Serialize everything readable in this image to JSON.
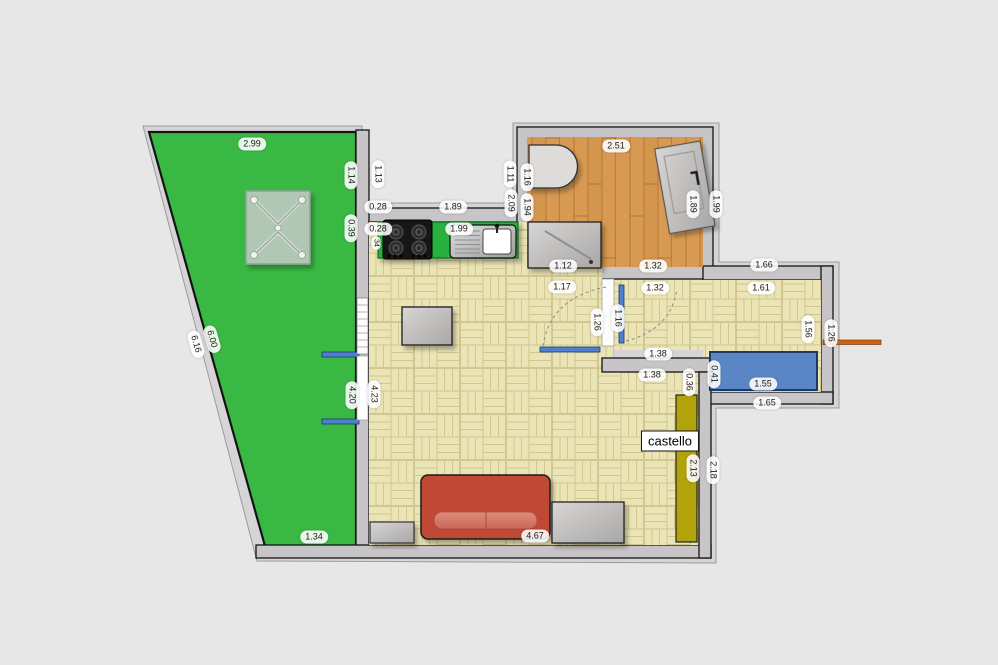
{
  "plan": {
    "type": "apartment-floor-plan",
    "room_label": "castello",
    "areas": [
      "garden",
      "kitchen",
      "bathroom",
      "living-room",
      "hallway",
      "corridor"
    ],
    "colors": {
      "background": "#e7e7e7",
      "garden_green": "#3ab844",
      "parquet": "#ebe4b6",
      "bathroom_wood": "#d89a52",
      "wall_gray": "#c7c5c7",
      "kitchen_counter_green": "#28b23c",
      "sofa_red": "#bf4a36",
      "wardrobe_blue": "#5b86c6",
      "castello_strip_yellow": "#b2a30c",
      "door_window_blue": "#4e7fd0",
      "entrance_door_orange": "#cf6414"
    }
  },
  "dimensions": [
    {
      "text": "2.99",
      "x": 252,
      "y": 144,
      "rot": 0
    },
    {
      "text": "1.14",
      "x": 351,
      "y": 175,
      "rot": 90
    },
    {
      "text": "0.39",
      "x": 351,
      "y": 228,
      "rot": 90
    },
    {
      "text": "1.13",
      "x": 378,
      "y": 174,
      "rot": 90
    },
    {
      "text": "0.28",
      "x": 378,
      "y": 207,
      "rot": 0
    },
    {
      "text": "1.89",
      "x": 453,
      "y": 207,
      "rot": 0
    },
    {
      "text": "1.11",
      "x": 510,
      "y": 174,
      "rot": 90
    },
    {
      "text": "2.09",
      "x": 511,
      "y": 203,
      "rot": 90
    },
    {
      "text": "0.28",
      "x": 378,
      "y": 229,
      "rot": 0
    },
    {
      "text": "34",
      "x": 376,
      "y": 243,
      "rot": 90,
      "small": true
    },
    {
      "text": "1.99",
      "x": 459,
      "y": 229,
      "rot": 0
    },
    {
      "text": "6.00",
      "x": 212,
      "y": 339,
      "rot": 74
    },
    {
      "text": "6.16",
      "x": 196,
      "y": 344,
      "rot": 74
    },
    {
      "text": "4.20",
      "x": 352,
      "y": 395,
      "rot": 90
    },
    {
      "text": "4.23",
      "x": 374,
      "y": 394,
      "rot": 90
    },
    {
      "text": "1.34",
      "x": 314,
      "y": 537,
      "rot": 0
    },
    {
      "text": "2.51",
      "x": 616,
      "y": 146,
      "rot": 0
    },
    {
      "text": "1.16",
      "x": 527,
      "y": 177,
      "rot": 90
    },
    {
      "text": "1.94",
      "x": 527,
      "y": 207,
      "rot": 90
    },
    {
      "text": "1.89",
      "x": 693,
      "y": 204,
      "rot": 90
    },
    {
      "text": "1.99",
      "x": 716,
      "y": 204,
      "rot": 90
    },
    {
      "text": "1.12",
      "x": 563,
      "y": 266,
      "rot": 0
    },
    {
      "text": "1.32",
      "x": 653,
      "y": 266,
      "rot": 0
    },
    {
      "text": "1.17",
      "x": 562,
      "y": 287,
      "rot": 0
    },
    {
      "text": "1.32",
      "x": 655,
      "y": 288,
      "rot": 0
    },
    {
      "text": "1.26",
      "x": 597,
      "y": 322,
      "rot": 90
    },
    {
      "text": "1.16",
      "x": 618,
      "y": 318,
      "rot": 90
    },
    {
      "text": "1.38",
      "x": 658,
      "y": 354,
      "rot": 0
    },
    {
      "text": "1.38",
      "x": 652,
      "y": 375,
      "rot": 0
    },
    {
      "text": "0.36",
      "x": 689,
      "y": 382,
      "rot": 90
    },
    {
      "text": "0.41",
      "x": 714,
      "y": 374,
      "rot": 90
    },
    {
      "text": "1.66",
      "x": 764,
      "y": 265,
      "rot": 0
    },
    {
      "text": "1.61",
      "x": 761,
      "y": 288,
      "rot": 0
    },
    {
      "text": "1.56",
      "x": 808,
      "y": 329,
      "rot": 90
    },
    {
      "text": "1.26",
      "x": 831,
      "y": 333,
      "rot": 90
    },
    {
      "text": "1.55",
      "x": 763,
      "y": 384,
      "rot": 0
    },
    {
      "text": "1.65",
      "x": 767,
      "y": 403,
      "rot": 0
    },
    {
      "text": "2.13",
      "x": 693,
      "y": 468,
      "rot": 90
    },
    {
      "text": "2.18",
      "x": 713,
      "y": 470,
      "rot": 90
    },
    {
      "text": "4.67",
      "x": 535,
      "y": 536,
      "rot": 0
    }
  ]
}
